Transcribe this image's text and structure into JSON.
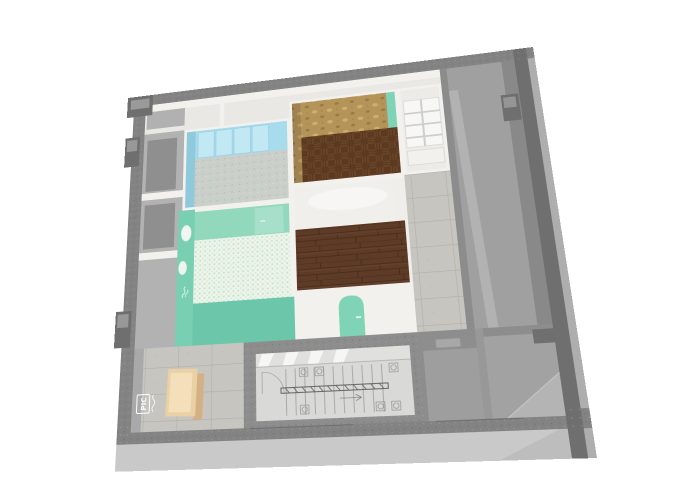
{
  "signs": {
    "entry_logo": "PIC"
  },
  "colors": {
    "bg": "#ffffff",
    "facade": "#c9c9c9",
    "facadeSide": "#aeaeae",
    "wallTop": "#838383",
    "wallMid": "#8d8d8d",
    "wallDark": "#6f6f6f",
    "innerWhite": "#f2f1ee",
    "corridorFloor": "#e9e8e5",
    "serviceGray": "#b2b2b2",
    "pocketGray": "#8f8f8f",
    "blueWall": "#a7dcec",
    "blueWallDark": "#8fc9dc",
    "bluePanel": "#c2e8f4",
    "carpet": "#cbcfc9",
    "mintWall": "#92d8bc",
    "mintFront": "#6cc6a9",
    "tealWall": "#79cfb2",
    "mosaicBase": "#edf4ea",
    "damaskBase": "#b5945a",
    "damaskMotif": "#cfae6e",
    "damaskDot": "#8a6a35",
    "parquetDark": "#5c3a21",
    "parquetMid": "#6b4527",
    "plankBase": "#5d3b26",
    "concreteTile": "#c7c5c0",
    "stairFloor": "#d9d9d7",
    "glazing": "#e0e0de",
    "grayRoomFloor": "#a2a2a2",
    "grayRoomWall": "#989898",
    "wedge": "#b4b4b4",
    "balcony": "#a0a0a0",
    "balconyShadow": "#898989",
    "bench": "#ead0a5",
    "benchSide": "#d3b184",
    "doorTeal": "#7fd3b6",
    "signWhite": "#ffffff",
    "closetFloor": "#ecebe8"
  }
}
